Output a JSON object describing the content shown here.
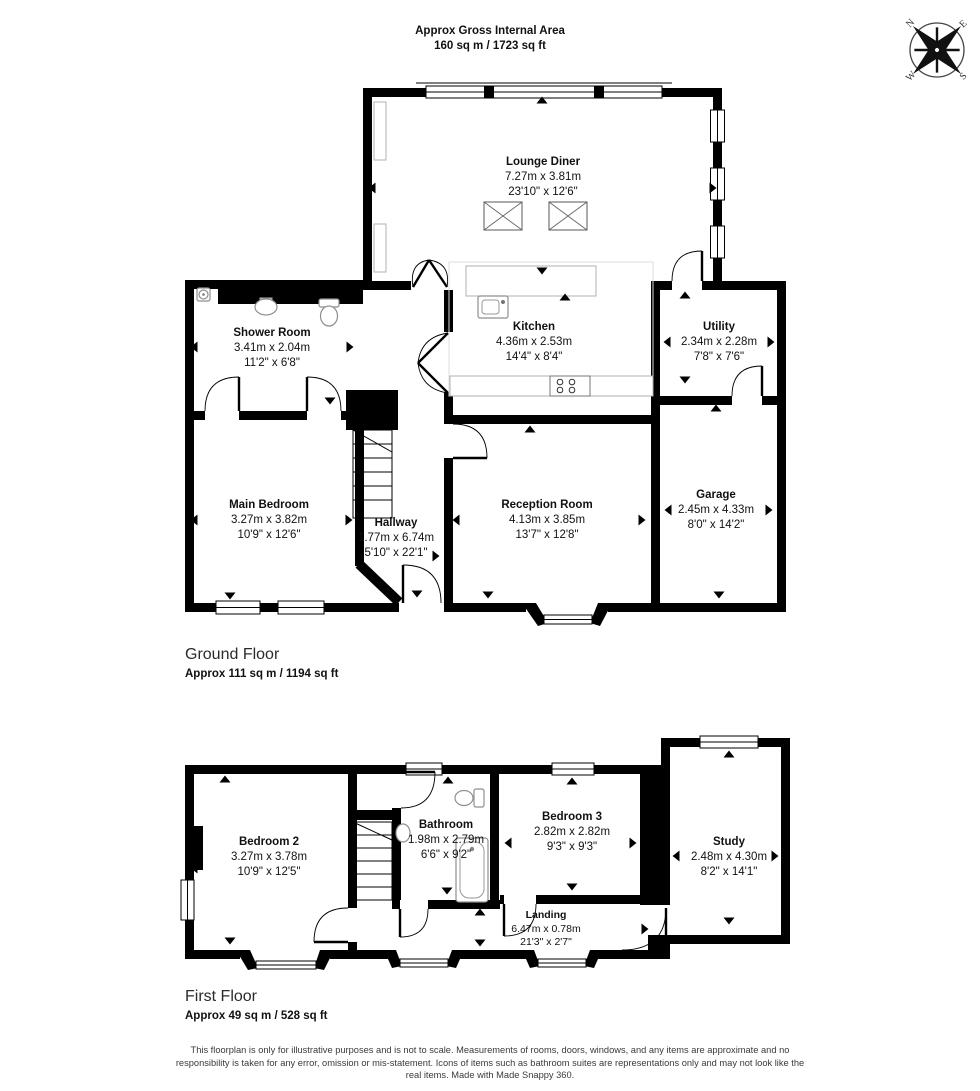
{
  "header": {
    "line1": "Approx Gross Internal Area",
    "line2": "160 sq m / 1723 sq ft"
  },
  "compass": {
    "north": "N",
    "east": "E",
    "south": "S",
    "west": "W"
  },
  "ground_floor": {
    "title": "Ground Floor",
    "area": "Approx 111 sq m / 1194 sq ft",
    "rooms": {
      "lounge": {
        "name": "Lounge Diner",
        "metric": "7.27m x 3.81m",
        "imperial": "23'10\" x 12'6\""
      },
      "shower": {
        "name": "Shower Room",
        "metric": "3.41m x 2.04m",
        "imperial": "11'2\" x 6'8\""
      },
      "kitchen": {
        "name": "Kitchen",
        "metric": "4.36m x 2.53m",
        "imperial": "14'4\" x 8'4\""
      },
      "utility": {
        "name": "Utility",
        "metric": "2.34m x 2.28m",
        "imperial": "7'8\" x 7'6\""
      },
      "main_bedroom": {
        "name": "Main Bedroom",
        "metric": "3.27m x 3.82m",
        "imperial": "10'9\" x 12'6\""
      },
      "hallway": {
        "name": "Hallway",
        "metric": "1.77m x 6.74m",
        "imperial": "5'10\" x 22'1\""
      },
      "reception": {
        "name": "Reception Room",
        "metric": "4.13m x 3.85m",
        "imperial": "13'7\" x 12'8\""
      },
      "garage": {
        "name": "Garage",
        "metric": "2.45m x 4.33m",
        "imperial": "8'0\" x 14'2\""
      }
    }
  },
  "first_floor": {
    "title": "First Floor",
    "area": "Approx 49 sq m / 528 sq ft",
    "rooms": {
      "bedroom2": {
        "name": "Bedroom 2",
        "metric": "3.27m x 3.78m",
        "imperial": "10'9\" x 12'5\""
      },
      "bathroom": {
        "name": "Bathroom",
        "metric": "1.98m x 2.79m",
        "imperial": "6'6\" x 9'2\""
      },
      "bedroom3": {
        "name": "Bedroom 3",
        "metric": "2.82m x 2.82m",
        "imperial": "9'3\" x 9'3\""
      },
      "study": {
        "name": "Study",
        "metric": "2.48m x 4.30m",
        "imperial": "8'2\" x 14'1\""
      },
      "landing": {
        "name": "Landing",
        "metric": "6.47m x 0.78m",
        "imperial": "21'3\" x 2'7\""
      }
    }
  },
  "footer": {
    "disclaimer": "This floorplan is only for illustrative purposes and is not to scale. Measurements of rooms, doors, windows, and any items are approximate and no responsibility is taken for any error, omission or mis-statement. Icons of items such as bathroom suites are representations only and may not look like the real items. Made with Made Snappy 360."
  },
  "colors": {
    "wall": "#000000",
    "fixture": "#8f8f8f",
    "counter": "#b0b0b0",
    "text": "#111111",
    "footer_text": "#3a3a3a"
  }
}
